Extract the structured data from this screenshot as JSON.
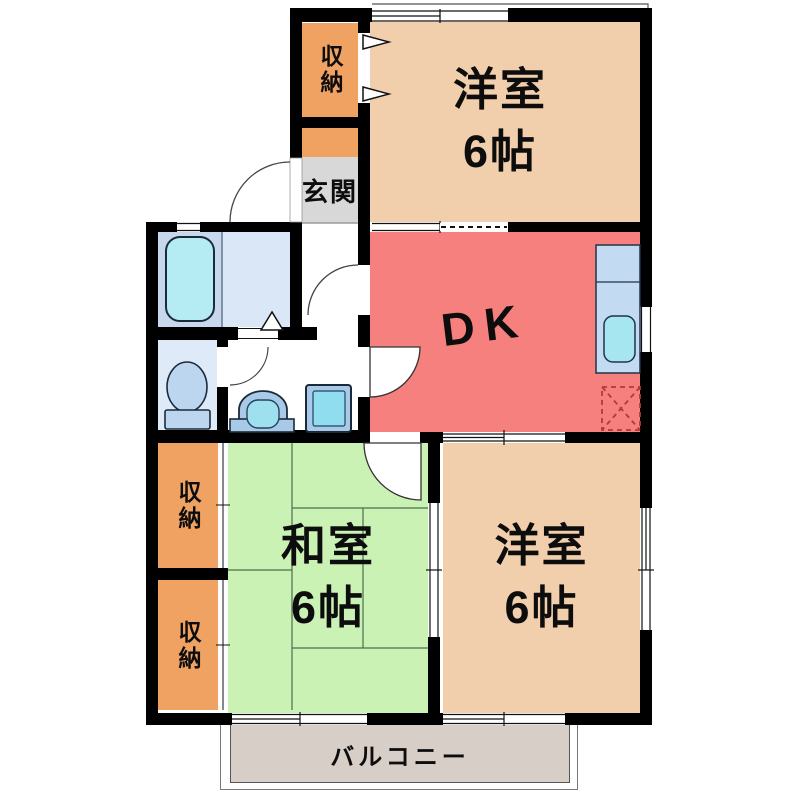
{
  "plan_title": "2DK apartment floor plan",
  "rooms": {
    "storage_top": {
      "label": "収納"
    },
    "entrance": {
      "label": "玄関"
    },
    "western_top": {
      "label": "洋室",
      "size": "6帖"
    },
    "dk": {
      "label": "DK"
    },
    "japanese": {
      "label": "和室",
      "size": "6帖"
    },
    "western_bottom": {
      "label": "洋室",
      "size": "6帖"
    },
    "storage_left_upper": {
      "label": "収納"
    },
    "storage_left_lower": {
      "label": "収納"
    },
    "balcony": {
      "label": "バルコニー"
    }
  },
  "fixtures": [
    "bathtub",
    "toilet",
    "washbasin",
    "washing-machine",
    "kitchen-counter",
    "kitchen-sink",
    "refrigerator-space"
  ],
  "colors": {
    "wall": "#000000",
    "western_room": "#F1CFAC",
    "dining_kitchen": "#F5807D",
    "japanese_room": "#C9F2B4",
    "storage": "#F0A262",
    "entrance_floor": "#D8D8D8",
    "balcony_deck": "#D8CEC8",
    "bathroom_floor": "#C7D7EE",
    "bathroom_floor_light": "#DAE7F7",
    "toilet_floor": "#DEEAF8",
    "fixture_blue": "#A9C9E8",
    "fixture_cyan": "#9FE0EE",
    "tub_cyan": "#B5EBF3"
  }
}
